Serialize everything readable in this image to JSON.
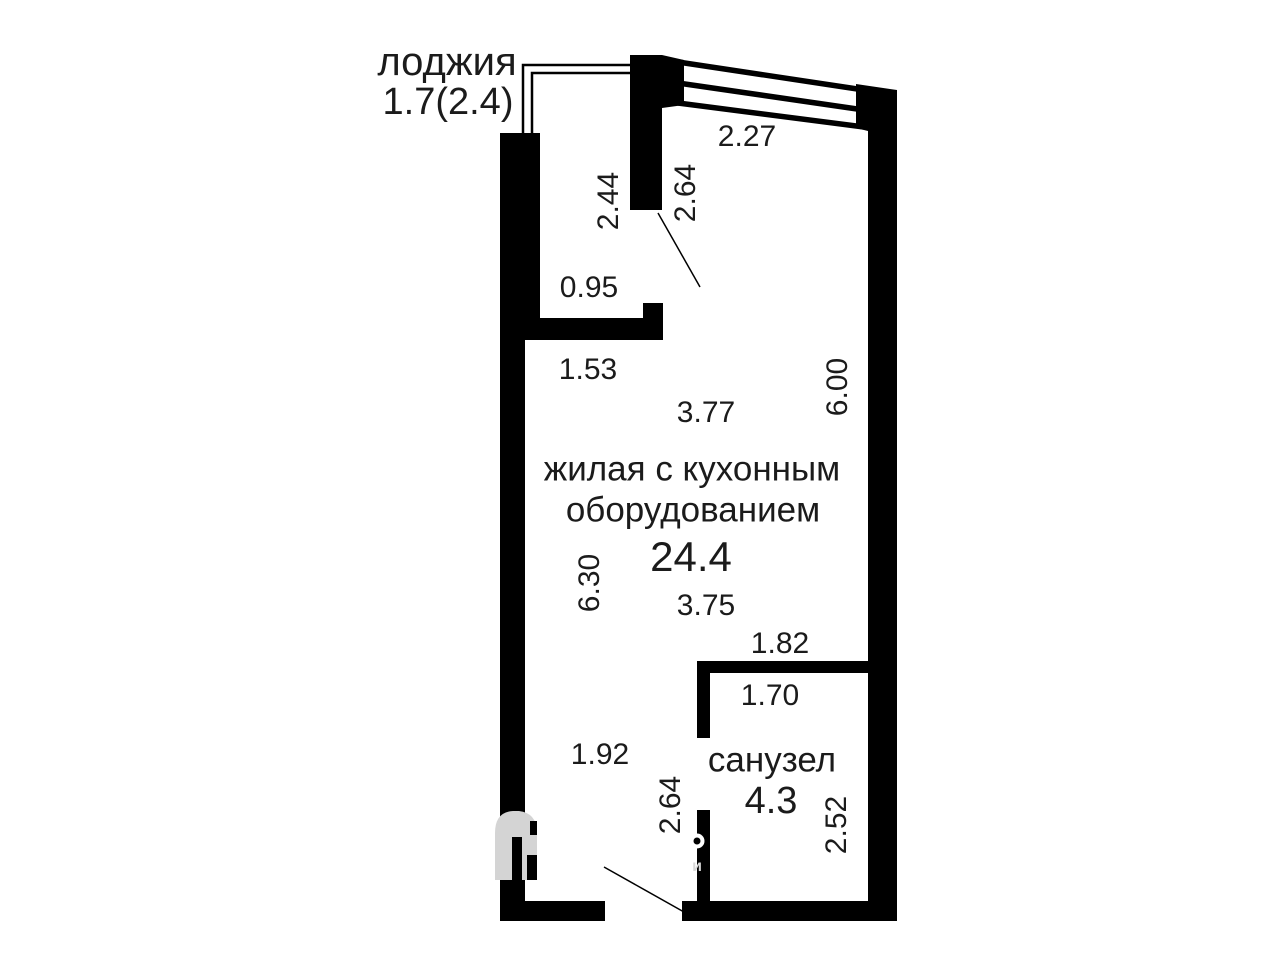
{
  "plan": {
    "loggia": {
      "label": "лоджия",
      "area_label": "1.7(2.4)"
    },
    "living": {
      "line1": "жилая с кухонным",
      "line2": "оборудованием",
      "area": "24.4"
    },
    "bathroom": {
      "label": "санузел",
      "area": "4.3"
    },
    "dims": {
      "niche_height": "2.44",
      "wall_right_of_niche": "2.64",
      "window_width": "2.27",
      "niche_width": "0.95",
      "upper_left_width": "1.53",
      "room_upper_width": "3.77",
      "room_right_height": "6.00",
      "room_left_height": "6.30",
      "room_lower_width": "3.75",
      "bathroom_outer_width": "1.82",
      "bathroom_inner_width": "1.70",
      "entry_width": "1.92",
      "partition_height": "2.64",
      "bathroom_inner_height": "2.52"
    },
    "watermark": {
      "letter": "и"
    },
    "colors": {
      "wall": "#000000",
      "text": "#1b1b1b",
      "watermark_gray": "#d4d4d4",
      "background": "#ffffff"
    }
  }
}
